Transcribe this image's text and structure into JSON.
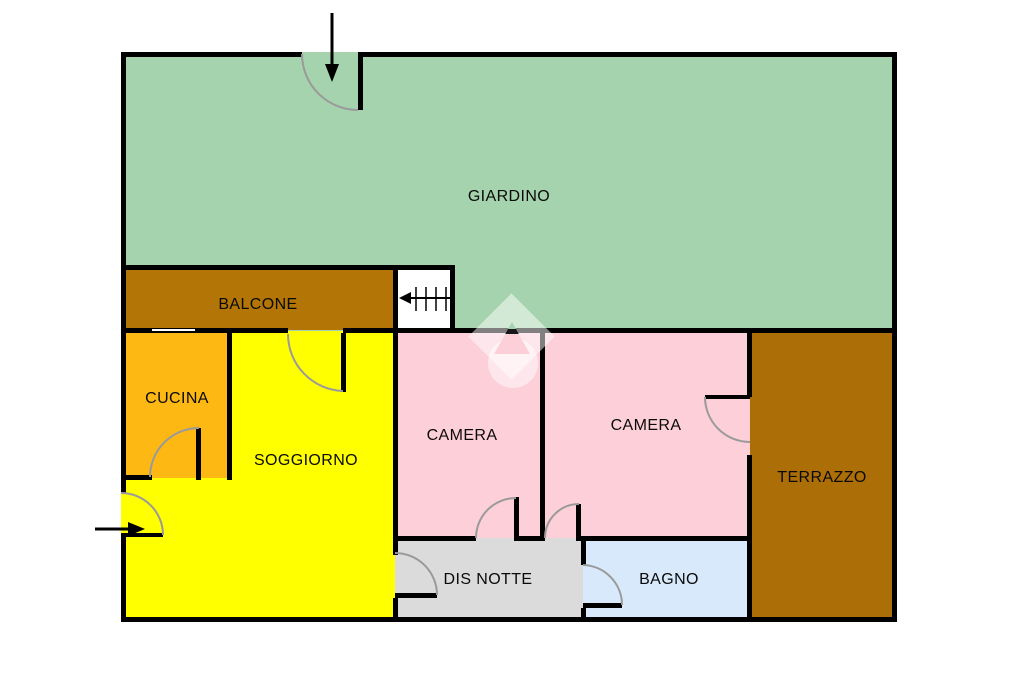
{
  "plan": {
    "title": "apartment floor plan",
    "rooms": {
      "giardino": {
        "label": "GIARDINO",
        "color": "#a5d3ad"
      },
      "balcone": {
        "label": "BALCONE",
        "color": "#b27506"
      },
      "cucina": {
        "label": "CUCINA",
        "color": "#fdb813"
      },
      "soggiorno": {
        "label": "SOGGIORNO",
        "color": "#ffff00"
      },
      "camera1": {
        "label": "CAMERA",
        "color": "#fdcfd8"
      },
      "camera2": {
        "label": "CAMERA",
        "color": "#fdcfd8"
      },
      "terrazzo": {
        "label": "TERRAZZO",
        "color": "#ac6f08"
      },
      "dis_notte": {
        "label": "DIS NOTTE",
        "color": "#dbdbdb"
      },
      "bagno": {
        "label": "BAGNO",
        "color": "#d7e9fa"
      }
    },
    "colors": {
      "wall": "#000000",
      "door_arc": "#9a9a9a",
      "background": "#ffffff",
      "watermark": "rgba(255,255,255,0.5)",
      "notch_gradient": "linear-gradient(#a5d3ad 0 22%, #161616 22% 38%, #fdcfd8 38% 100%)",
      "arrow": "#000000",
      "stairs_box": "#ffffff"
    },
    "icons": {
      "top_entrance": "arrow-down-icon",
      "side_entrance": "arrow-right-icon",
      "stairs": "stairs-ladder-icon",
      "watermark": "diamond-house-watermark"
    }
  }
}
